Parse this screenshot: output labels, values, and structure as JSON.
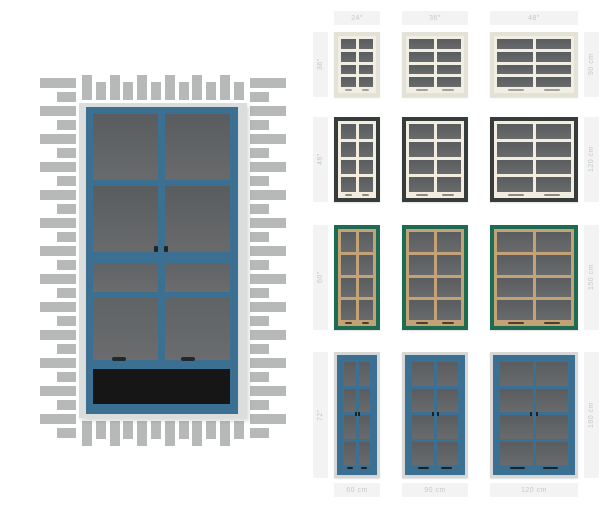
{
  "chart": {
    "columns": [
      {
        "width_in": "24″",
        "width_cm": "60 cm"
      },
      {
        "width_in": "36″",
        "width_cm": "90 cm"
      },
      {
        "width_in": "48″",
        "width_cm": "120 cm"
      }
    ],
    "rows": [
      {
        "height_in": "36″",
        "height_cm": "90 cm",
        "name": "white",
        "frame_color": "#e4e1d7",
        "grid_color": "#f1eee3",
        "handle_color": "#a5a196"
      },
      {
        "height_in": "48″",
        "height_cm": "120 cm",
        "name": "black",
        "frame_color": "#353c3a",
        "grid_color": "#f2edde",
        "handle_color": "#8f8a7c"
      },
      {
        "height_in": "60″",
        "height_cm": "150 cm",
        "name": "green",
        "frame_color": "#1d6b50",
        "grid_color": "#c3a277",
        "handle_color": "#4e3f2c"
      },
      {
        "height_in": "72″",
        "height_cm": "180 cm",
        "name": "blue",
        "frame_color": "#3c7093",
        "grid_color": "#3c7093",
        "outer_trim": "#d5d8d6",
        "handle_color": "#1c2125",
        "latches": true
      }
    ],
    "label_bg": "#f2f3f2",
    "label_text": "#c6c9c8",
    "glass_top": "#5a5d5f",
    "glass_bottom": "#686a6c"
  },
  "preview": {
    "frame_color": "#3c7093",
    "trim_color": "#dadddb",
    "brick_color": "#b6b9b7",
    "glass_top": "#5a5d5f",
    "glass_bottom": "#686a6c",
    "opening_color": "#161616"
  }
}
